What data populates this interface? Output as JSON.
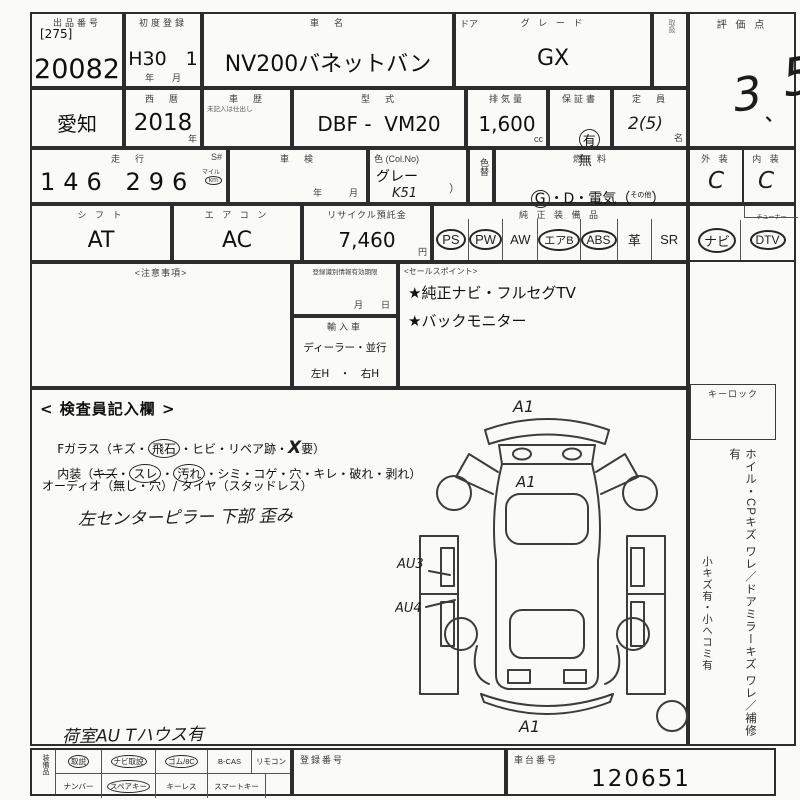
{
  "header": {
    "auction_label": "出品番号",
    "auction_bracket": "[275]",
    "auction_no": "20082",
    "first_reg_label": "初度登録",
    "first_reg": "H30　1",
    "first_reg_unit": "年　　月",
    "car_name_label": "車　名",
    "car_name": "NV200バネットバン",
    "door_label": "ドア",
    "grade_label": "グ レ ー ド",
    "grade": "GX",
    "small_box_label": "取扱",
    "score_label": "評 価 点",
    "score_d1": "3",
    "score_mark": "、",
    "score_d2": "5"
  },
  "row2": {
    "prefecture": "愛知",
    "year_label": "西　暦",
    "year": "2018",
    "year_unit": "年",
    "history_label": "車　歴",
    "history_note": "未記入は仕出し",
    "model_label": "型　式",
    "model": "DBF -  VM20",
    "disp_label": "排気量",
    "disp": "1,600",
    "disp_unit": "cc",
    "warranty_label": "保証書",
    "warranty_yes": "有",
    "warranty_no": "無",
    "capacity_label": "定　員",
    "capacity": "2(5)",
    "capacity_unit": "名"
  },
  "row3": {
    "mileage_label": "走　行",
    "mileage_s": "S#",
    "mileage": "146 296",
    "mile_unit": "マイル",
    "km_unit": "km",
    "shaken_label": "車　検",
    "shaken_units": "年　　　月",
    "color_label": "色 (Col.No)",
    "color": "グレー",
    "color_no": "K51",
    "color_paren": "）",
    "color_change_label": "色替",
    "fuel_label": "燃　料",
    "fuel_g": "G",
    "fuel_rest": "・D・電気（",
    "fuel_other": "その他",
    "fuel_close": "）"
  },
  "row4": {
    "shift_label": "シ フ ト",
    "shift": "AT",
    "aircon_label": "エ ア コ ン",
    "aircon": "AC",
    "recycle_label": "リサイクル預託金",
    "recycle": "7,460",
    "recycle_unit": "円",
    "equip_label": "純 正 装 備 品",
    "badges": [
      {
        "label": "PS",
        "circled": true
      },
      {
        "label": "PW",
        "circled": true
      },
      {
        "label": "AW",
        "circled": false
      },
      {
        "label": "エアB",
        "circled": true
      },
      {
        "label": "ABS",
        "circled": true
      },
      {
        "label": "革",
        "circled": false
      },
      {
        "label": "SR",
        "circled": false
      }
    ],
    "tuner_label": "チューナー",
    "nav_label": "ナビ",
    "nav_circled": true,
    "dtv_label": "DTV",
    "dtv_circled": true
  },
  "right": {
    "ext_label": "外 装",
    "ext": "C",
    "int_label": "内 装",
    "int": "C",
    "keylock_label": "キーロック",
    "side_text1": "ホイル・CPキズ ワレ／ドアミラーキズ ワレ／補修有",
    "side_text2": "小キズ有・小ヘコミ有"
  },
  "notice": {
    "label": "<注意事項>"
  },
  "reginfo": {
    "label": "登録識別情報有効期限",
    "units": "月　　日",
    "import_label": "輸入車",
    "import_opts": "ディーラー・並行",
    "lr": "左H　・　右H"
  },
  "sales": {
    "label": "<セールスポイント>",
    "p1": "★純正ナビ・フルセグTV",
    "p2": "★バックモニター"
  },
  "inspector": {
    "title": "< 検査員記入欄 >",
    "glass_p1": "Fガラス（キズ・",
    "glass_c1": "飛石",
    "glass_p2": "・ヒビ・リペア跡・",
    "glass_x": "X",
    "glass_p3": "要）",
    "int_p0": "内装（",
    "int_s1": "キズ",
    "int_p1": "・",
    "int_c1": "スレ",
    "int_p2": "・",
    "int_c2": "汚れ",
    "int_p3": "・シミ・コゲ・穴・キレ・破れ・剥れ）",
    "audio": "オーディオ（無し・穴）/ タイヤ（スタッドレス）",
    "note1": "左センターピラー 下部 歪み",
    "note2": "荷室AU Tハウス有"
  },
  "diagram": {
    "a1_top": "A1",
    "a1_hood": "A1",
    "au3": "AU3",
    "au4": "AU4",
    "a1_rear": "A1"
  },
  "bottom": {
    "vert_label": "装備品",
    "row1": [
      {
        "label": "取説",
        "circled": true
      },
      {
        "label": "ナビ取説",
        "circled": true
      },
      {
        "label": "ゴム/8C",
        "circled": true
      },
      {
        "label": "B-CAS",
        "circled": false
      },
      {
        "label": "リモコン",
        "circled": false
      }
    ],
    "row2": [
      {
        "label": "ナンバー",
        "circled": false
      },
      {
        "label": "スペアキー",
        "circled": true
      },
      {
        "label": "キーレス",
        "circled": false
      },
      {
        "label": "スマートキー",
        "circled": false
      },
      {
        "label": "",
        "circled": false
      }
    ],
    "reg_label": "登録番号",
    "chassis_label": "車台番号",
    "chassis": "120651"
  }
}
